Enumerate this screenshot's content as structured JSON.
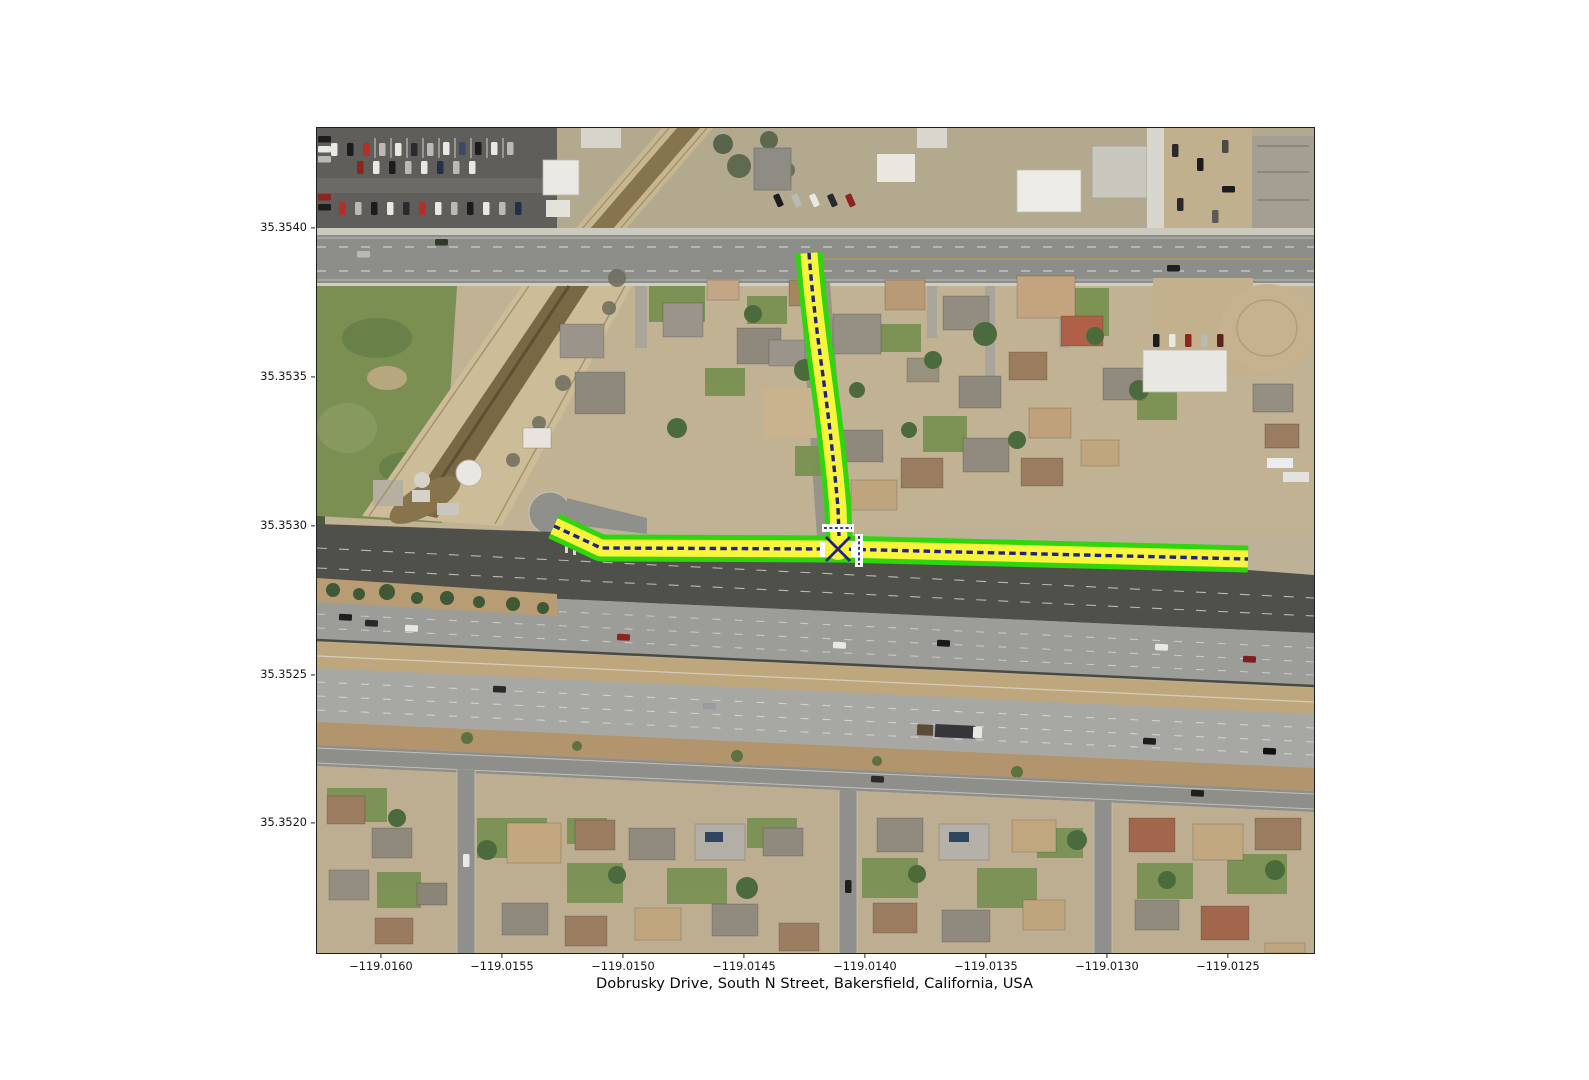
{
  "figure": {
    "title": "Dobrusky Drive, South N Street, Bakersfield, California, USA",
    "background": "#ffffff"
  },
  "axes": {
    "yticks": [
      {
        "label": "35.3540",
        "px": 101
      },
      {
        "label": "35.3535",
        "px": 250
      },
      {
        "label": "35.3530",
        "px": 399
      },
      {
        "label": "35.3525",
        "px": 548
      },
      {
        "label": "35.3520",
        "px": 696
      }
    ],
    "xticks": [
      {
        "label": "−119.0160",
        "px": 65
      },
      {
        "label": "−119.0155",
        "px": 186
      },
      {
        "label": "−119.0150",
        "px": 307
      },
      {
        "label": "−119.0145",
        "px": 428
      },
      {
        "label": "−119.0140",
        "px": 549
      },
      {
        "label": "−119.0135",
        "px": 670
      },
      {
        "label": "−119.0130",
        "px": 791
      },
      {
        "label": "−119.0125",
        "px": 912
      }
    ]
  },
  "route": {
    "colors": {
      "casing": "#2fd60e",
      "fill": "#f8f53c",
      "centerline": "#23237b",
      "crosswalk": "#ffffff"
    }
  }
}
